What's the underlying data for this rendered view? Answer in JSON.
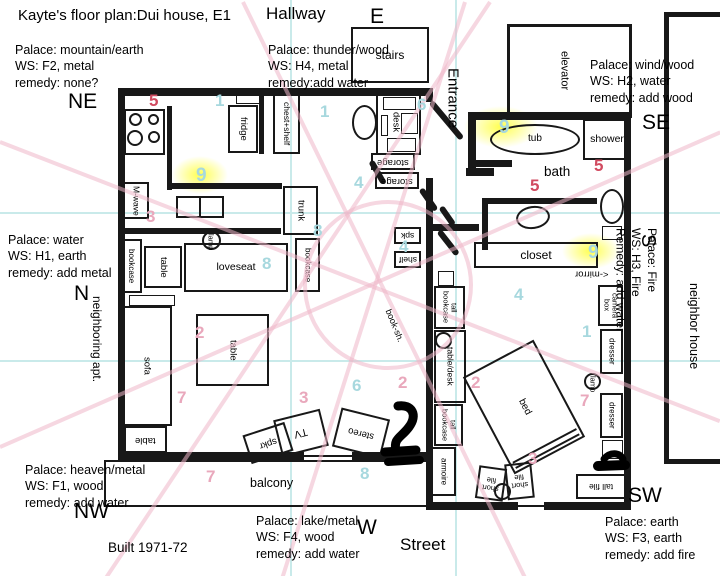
{
  "title": "Kayte's floor plan:Dui house, E1",
  "built_label": "Built 1971-72",
  "colors": {
    "number_red": "#d14b60",
    "number_pink": "#e9a8bc",
    "number_blue": "#a7d8de",
    "highlight_yellow": "#ffff46",
    "line_pink": "#eeb7c8",
    "line_cyan": "#c9eaea",
    "wall_black": "#181818"
  },
  "directions": {
    "ne": "NE",
    "e": "E",
    "se": "SE",
    "n": "N",
    "s": "S",
    "nw": "NW",
    "w": "W",
    "sw": "SW"
  },
  "area_labels": {
    "hallway": "Hallway",
    "entrance": "Entrance",
    "street": "Street",
    "balcony": "balcony",
    "bath": "bath",
    "neighboring_apt": "neighboring apt.",
    "neighbor_house": "neighbor house",
    "mirror_note": "<-mirror"
  },
  "palaces": {
    "mountain": [
      "Palace: mountain/earth",
      "WS: F2, metal",
      "remedy: none?"
    ],
    "thunder": [
      "Palace: thunder/wood",
      "WS: H4, metal",
      "remedy:add water"
    ],
    "wind": [
      "Palace: wind/wood",
      "WS: H2, water",
      "remedy: add wood"
    ],
    "water": [
      "Palace: water",
      "WS: H1, earth",
      "remedy: add metal"
    ],
    "fire": [
      "Palace: Fire",
      "WS: H3, Fire",
      "Remedy: add water"
    ],
    "heaven": [
      "Palace: heaven/metal",
      "WS: F1, wood",
      "remedy: add water"
    ],
    "lake": [
      "Palace: lake/metal",
      "WS: F4, wood",
      "remedy: add water"
    ],
    "earth": [
      "Palace: earth",
      "WS: F3, earth",
      "remedy: add fire"
    ]
  },
  "furniture": {
    "stairs": "stairs",
    "elevator": "elevator",
    "fridge": "fridge",
    "chest_shelf": "chest+shelf",
    "mwave": "M-wave",
    "trunk": "trunk",
    "desk": "desk",
    "storage": "storage",
    "spk": "spk",
    "shelf": "shelf",
    "tub": "tub",
    "shower": "shower",
    "closet": "closet",
    "bookcase": "bookcase",
    "table": "table",
    "lamp": "lamp",
    "loveseat": "loveseat",
    "sofa": "sofa",
    "tv": "TV",
    "stereo": "stereo",
    "spkr": "spkr",
    "book_sh": "book-sh.",
    "tall_bookcase": "tall bookcase",
    "table_desk": "table/desk",
    "armoire": "armoire",
    "camera_box": "camera box",
    "dresser": "dresser",
    "bed": "bed",
    "short_file": "short file",
    "tall_file": "tall file"
  },
  "numbers": [
    {
      "value": "5",
      "color": "red"
    },
    {
      "value": "1",
      "color": "blue"
    },
    {
      "value": "1",
      "color": "blue"
    },
    {
      "value": "6",
      "color": "blue"
    },
    {
      "value": "9",
      "color": "blue"
    },
    {
      "value": "3",
      "color": "pink"
    },
    {
      "value": "4",
      "color": "blue"
    },
    {
      "value": "8",
      "color": "blue"
    },
    {
      "value": "8",
      "color": "blue"
    },
    {
      "value": "4",
      "color": "blue"
    },
    {
      "value": "2",
      "color": "pink"
    },
    {
      "value": "7",
      "color": "pink"
    },
    {
      "value": "3",
      "color": "pink"
    },
    {
      "value": "6",
      "color": "blue"
    },
    {
      "value": "2",
      "color": "pink"
    },
    {
      "value": "7",
      "color": "pink"
    },
    {
      "value": "8",
      "color": "blue"
    },
    {
      "value": "9",
      "color": "blue"
    },
    {
      "value": "5",
      "color": "red"
    },
    {
      "value": "5",
      "color": "red"
    },
    {
      "value": "9",
      "color": "blue"
    },
    {
      "value": "4",
      "color": "blue"
    },
    {
      "value": "1",
      "color": "blue"
    },
    {
      "value": "2",
      "color": "pink"
    },
    {
      "value": "7",
      "color": "pink"
    },
    {
      "value": "3",
      "color": "pink"
    }
  ]
}
